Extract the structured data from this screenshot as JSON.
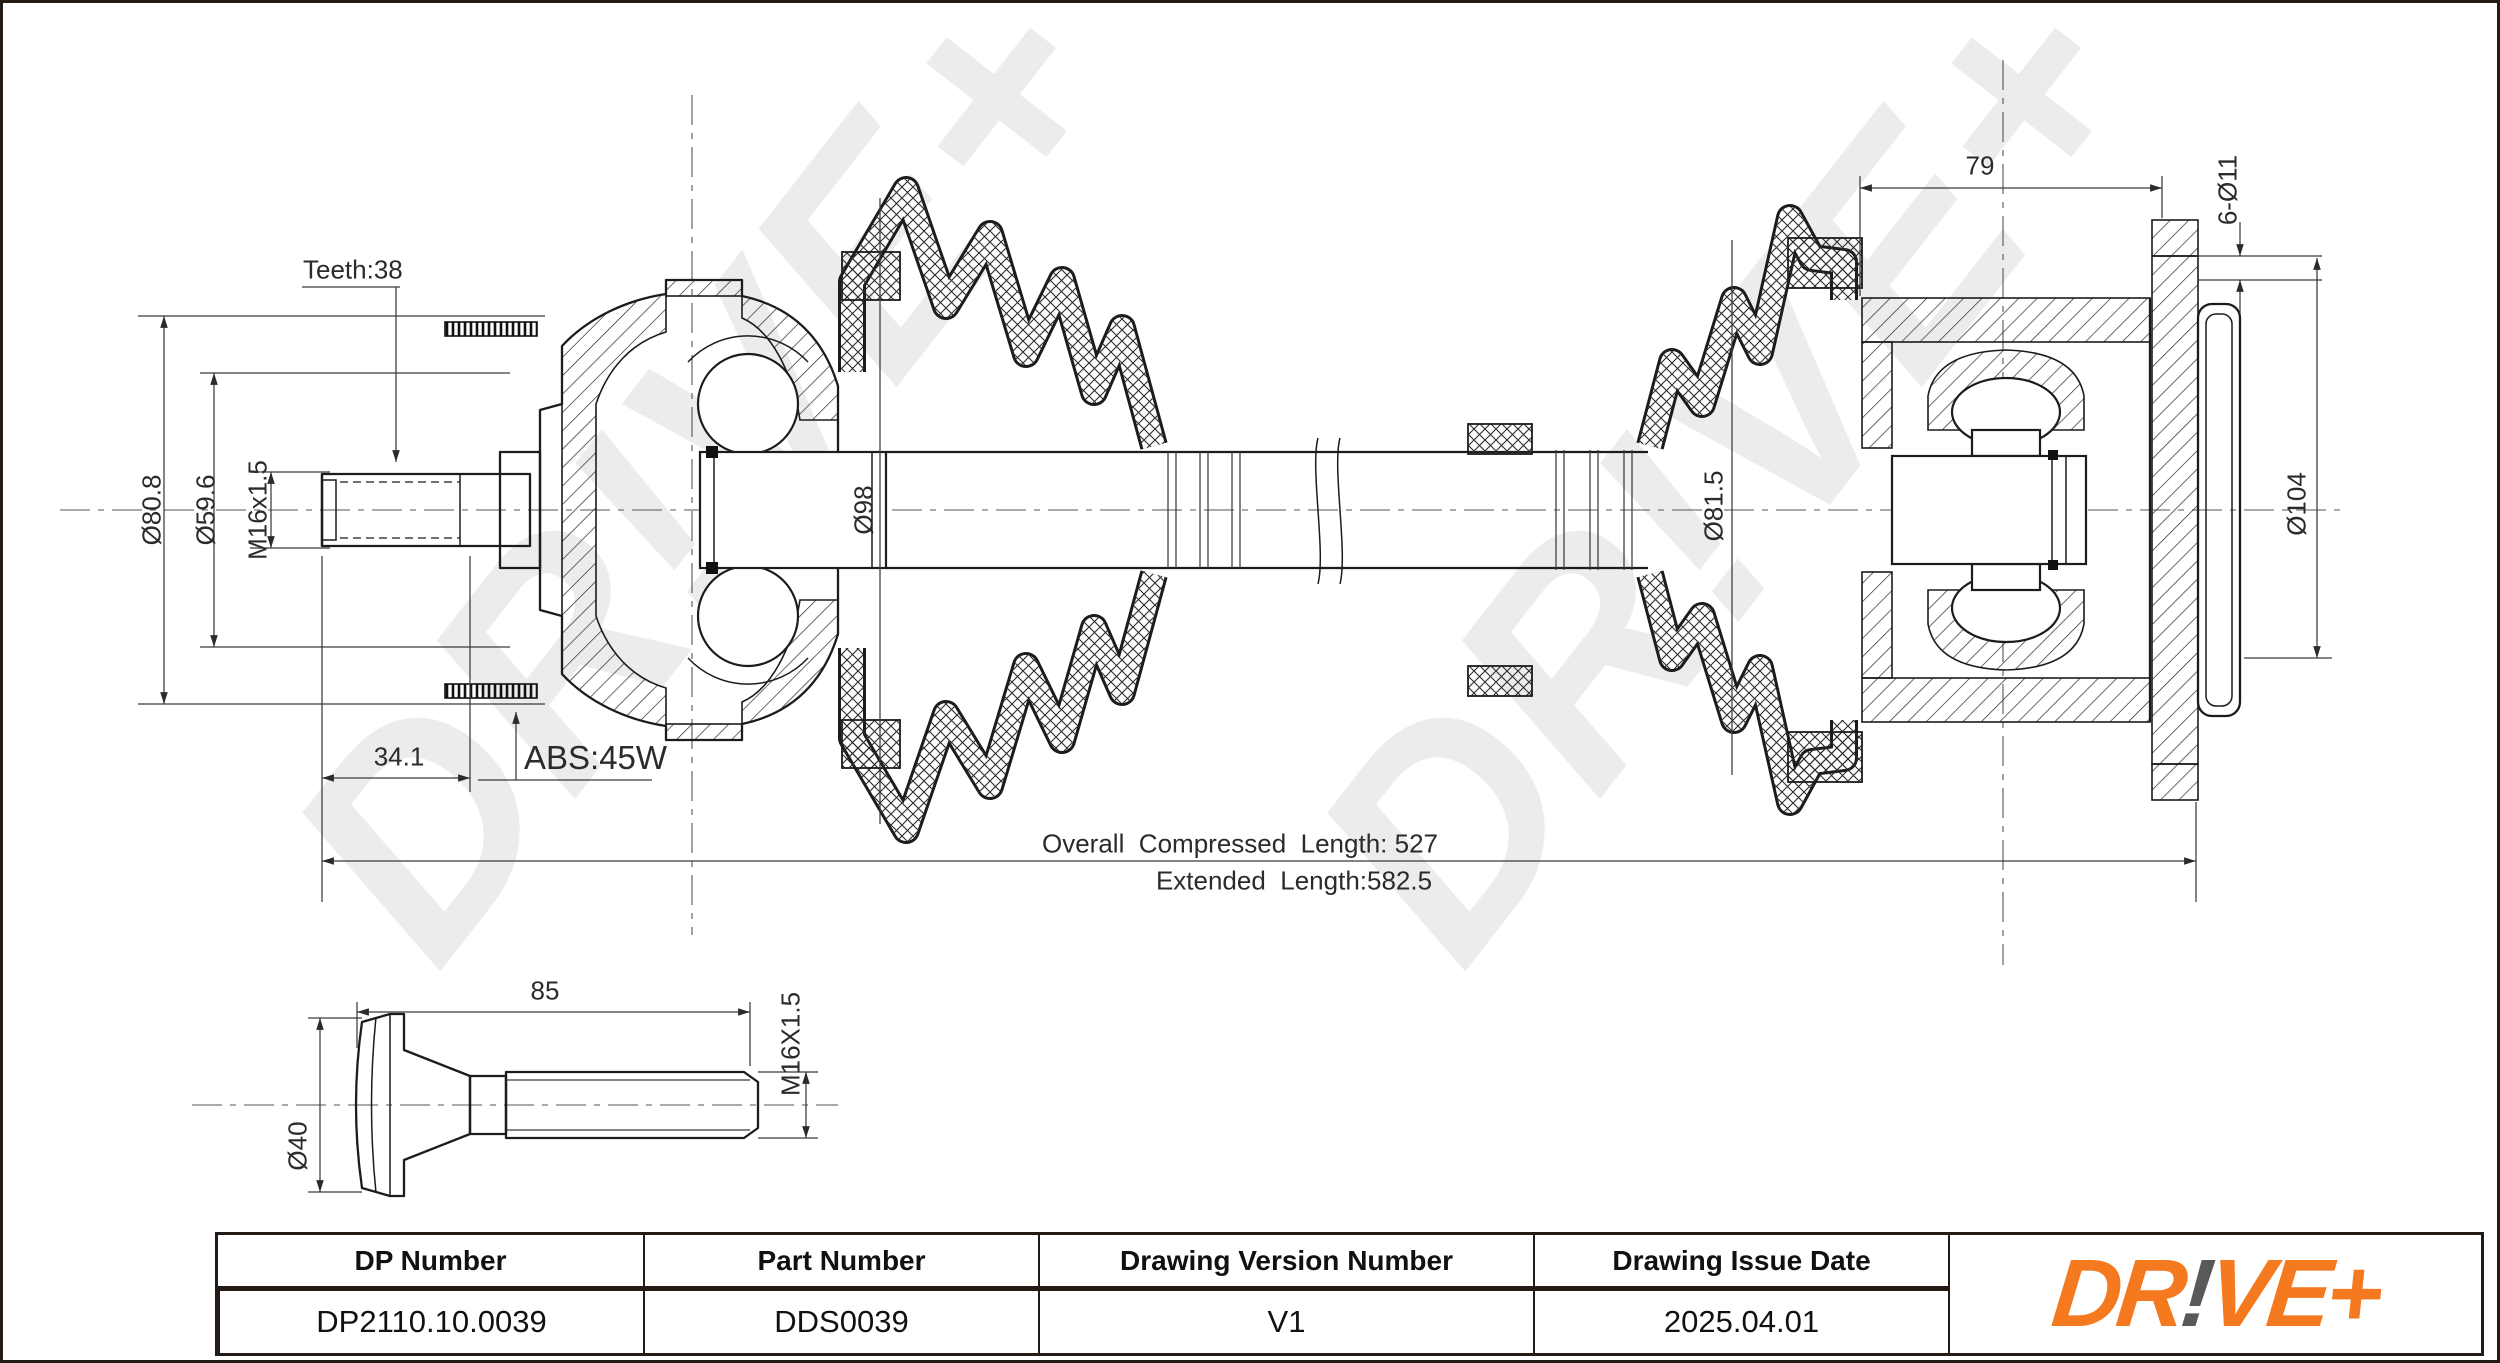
{
  "drawing": {
    "labels": {
      "teeth": "Teeth:38",
      "dia_outer": "Ø80.8",
      "dia_inner": "Ø59.6",
      "thread_bore": "M16x1.5",
      "spline_len": "34.1",
      "abs_ring": "ABS:45W",
      "dia_joint": "Ø98",
      "flange_width": "79",
      "bolt_holes": "6-Ø11",
      "dia_shaft_seat": "Ø81.5",
      "dia_flange": "Ø104",
      "compressed_length": "Overall  Compressed  Length: 527",
      "extended_length": "Extended  Length:582.5"
    },
    "bolt": {
      "length": "85",
      "thread": "M16X1.5",
      "head_dia": "Ø40"
    },
    "watermark": "DR!VE+"
  },
  "table": {
    "headers": [
      "DP Number",
      "Part Number",
      "Drawing Version Number",
      "Drawing Issue Date"
    ],
    "values": [
      "DP2110.10.0039",
      "DDS0039",
      "V1",
      "2025.04.01"
    ]
  },
  "logo": {
    "pre": "DR",
    "bang": "!",
    "post": "VE",
    "plus": "+"
  },
  "colors": {
    "accent": "#F4791F",
    "logo_gray": "#58595B",
    "line": "#241a16",
    "watermark": "#ECECEC"
  }
}
